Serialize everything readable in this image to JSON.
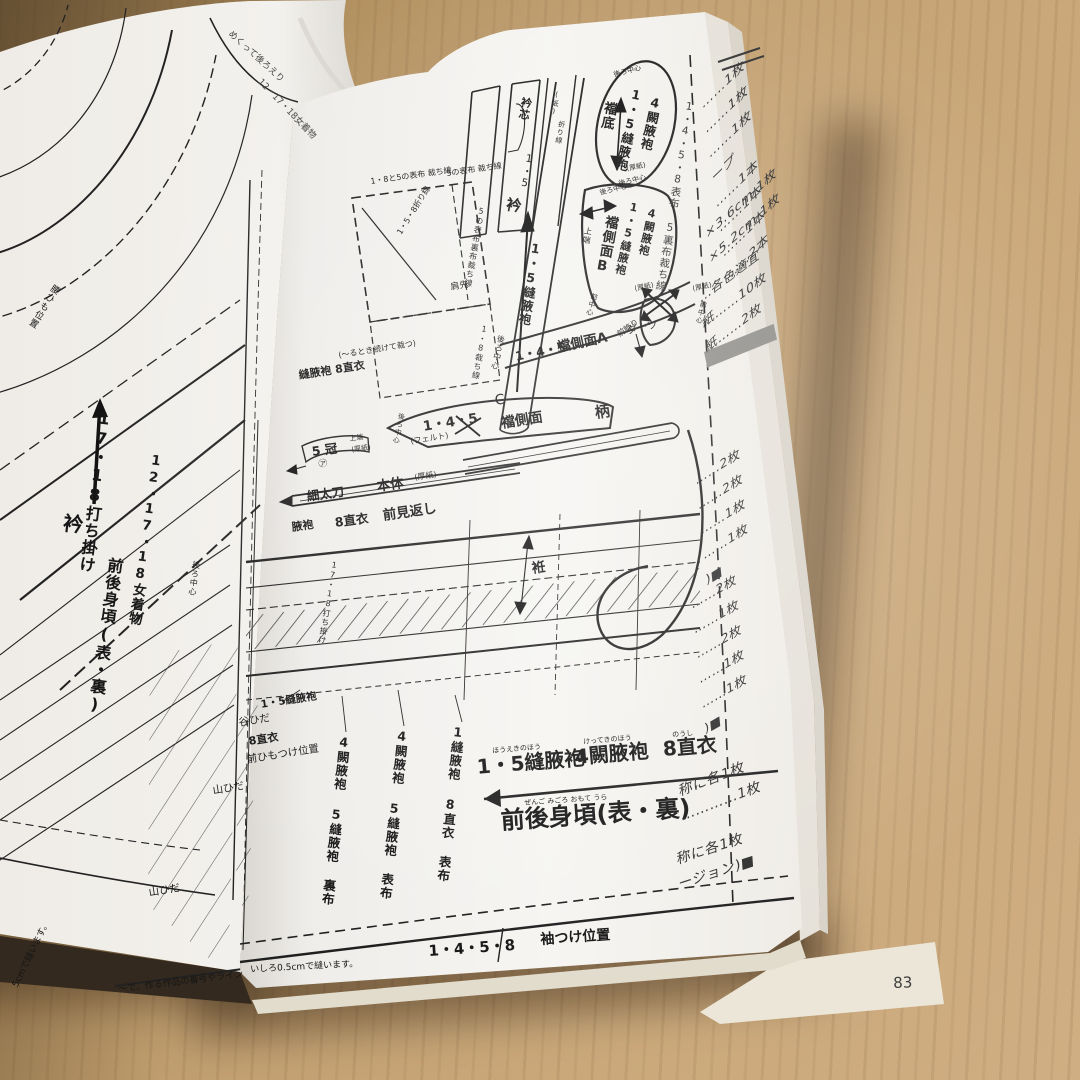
{
  "photo": {
    "description": "Open Japanese sewing-pattern book lying on a wooden table",
    "page_number": "83"
  },
  "left_page": {
    "corner_note_1": "めくって後ろえり",
    "corner_note_2": "12・17・18女着物",
    "uchikake": "17・18打ち掛け",
    "eri": "衿",
    "onna_kimono": "12・17・18女着物",
    "migoro": "前後身頃(表・裏)",
    "ushiro_chushin": "後ろ中心",
    "koshihimo": "腰ひも位置",
    "yamahida": "山ひだ",
    "fold_note": "17・18打ち掛け",
    "footnote_seam": "5cmで縫います。",
    "footnote_marker": "〜で、作る作品の番号やライン"
  },
  "right_page": {
    "strips": {
      "erishin": "衿芯",
      "num": "1・5",
      "kami": "(紙)",
      "orisen": "折り線",
      "eri": "衿",
      "eri_piece": "1・5縫腋袍"
    },
    "machizoko": {
      "top": "後ろ中心",
      "name": "襠底",
      "hoeki": "1・5縫腋袍",
      "ketteki": "4闕腋袍",
      "atsugami": "(厚紙)",
      "bottom": "後ろ中心"
    },
    "edge_note": "1・4・5・8表布 5裏布裁ち線",
    "side_b": {
      "back": "後ろ中心",
      "top_end": "上端",
      "name": "襠側面B",
      "hoeki": "1・5縫腋袍",
      "ketteki": "4闕腋袍",
      "front": "前中心",
      "atsugami": "(厚紙)",
      "kazari": "前飾り"
    },
    "cut_box": {
      "line1": "1・8と5の表布 裁ち線",
      "line2": "5の表布 裁ち線",
      "fold": "1・5・8折り線",
      "kata": "肩先",
      "ura": "5の表布裏布裁ち線",
      "cut18": "1・8裁ち線",
      "back": "後ろ中心",
      "note": "(〜るとき続けて裁つ)",
      "piece": "縫腋袍 8直衣"
    },
    "side_a": {
      "nums": "1・4・5",
      "name": "襠側面A",
      "darts": "ダーツ",
      "atsugami": "(厚紙)",
      "front": "前中心"
    },
    "side_c": {
      "c": "C",
      "nums": "1・4・5",
      "back": "後ろ中心",
      "felt": "(フェルト)",
      "name": "襠側面",
      "tsuka": "柄"
    },
    "kanmuri": {
      "name": "5 冠",
      "top_end": "上端",
      "atsugami": "(厚紙)",
      "mark": "㋐"
    },
    "tachi": {
      "name": "細太刀",
      "body": "本体",
      "atsugami": "(厚紙)"
    },
    "mikaeshi": {
      "left": "腋袍",
      "noushi": "8直衣",
      "name": "前見返し"
    },
    "okumi": "袵",
    "column_labels": [
      "1縫腋袍 8直衣 表布",
      "4闕腋袍 5縫腋袍 表布",
      "4闕腋袍 5縫腋袍 裏布"
    ],
    "left_labels": {
      "hoeki": "1・5縫腋袍",
      "tanihida": "谷ひだ",
      "noushi": "8直衣",
      "himo": "前ひもつけ位置",
      "yamahida": "山ひだ"
    },
    "bottom": {
      "hoeki": "1・5縫腋袍",
      "hoeki_kana": "ほうえきのほう",
      "ketteki": "4闕腋袍",
      "ketteki_kana": "けってきのほう",
      "noushi": "8直衣",
      "noushi_kana": "のうし",
      "migoro": "前後身頃(表・裏)",
      "migoro_kana": "ぜんご みごろ おもて うら",
      "nums": "1・4・5・8",
      "sode": "袖つけ位置",
      "footnote": "いしろ0.5cmで縫います。"
    }
  },
  "materials_page": {
    "list1": [
      "……1枚",
      "……1枚",
      "……1枚",
      "ープ",
      "……1本",
      "……1本",
      "……1本",
      "……2本"
    ],
    "list2": [
      "×3.6cm 1枚",
      "×5.2cm 1枚"
    ],
    "list3": [
      "…各色適宜",
      "紙……10枚",
      "紙……2枚"
    ],
    "list4": [
      "……2枚",
      "……2枚",
      "……1枚",
      "……1枚",
      ")■"
    ],
    "list5": [
      "……2枚",
      "……1枚",
      "……2枚",
      "……1枚",
      "……1枚",
      ")■"
    ],
    "list6": [
      "称に各1枚",
      "…………1枚"
    ],
    "list7": [
      "称に各1枚",
      "ージョン)■"
    ],
    "page_number": "83"
  }
}
